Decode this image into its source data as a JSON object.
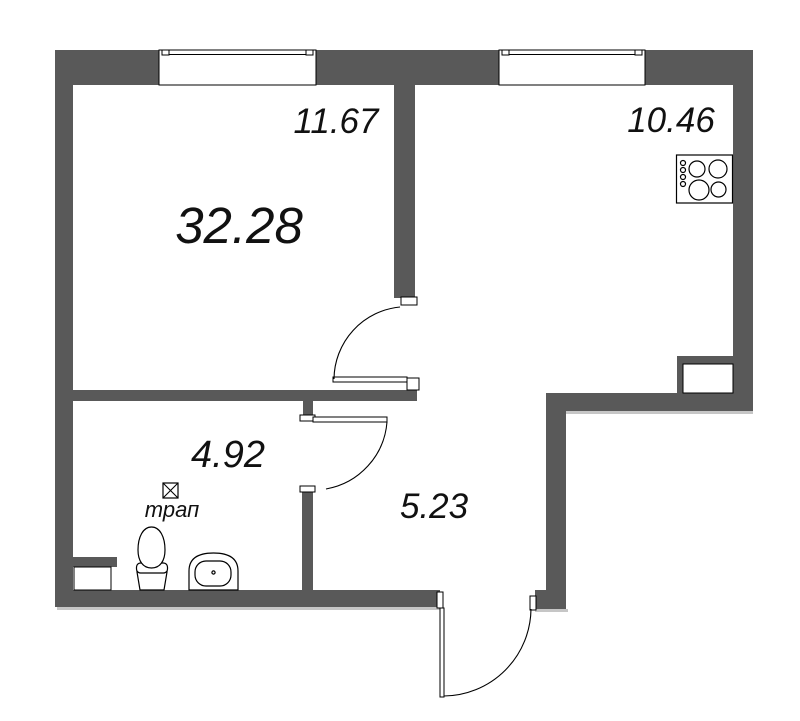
{
  "plan": {
    "colors": {
      "wall": "#595959",
      "line": "#000000",
      "shadow": "#c6c6c6",
      "text": "#111111",
      "background": "#ffffff"
    },
    "rooms": {
      "total": {
        "area": "32.28"
      },
      "living": {
        "area": "11.67"
      },
      "kitchen": {
        "area": "10.46"
      },
      "bathroom": {
        "area": "4.92"
      },
      "hallway": {
        "area": "5.23"
      }
    },
    "fixtures": {
      "drain_label": "трап",
      "icons": [
        "stove-icon",
        "toilet-icon",
        "sink-icon",
        "drain-icon"
      ]
    },
    "structure": {
      "windows": 2,
      "door_swings": 3
    }
  }
}
